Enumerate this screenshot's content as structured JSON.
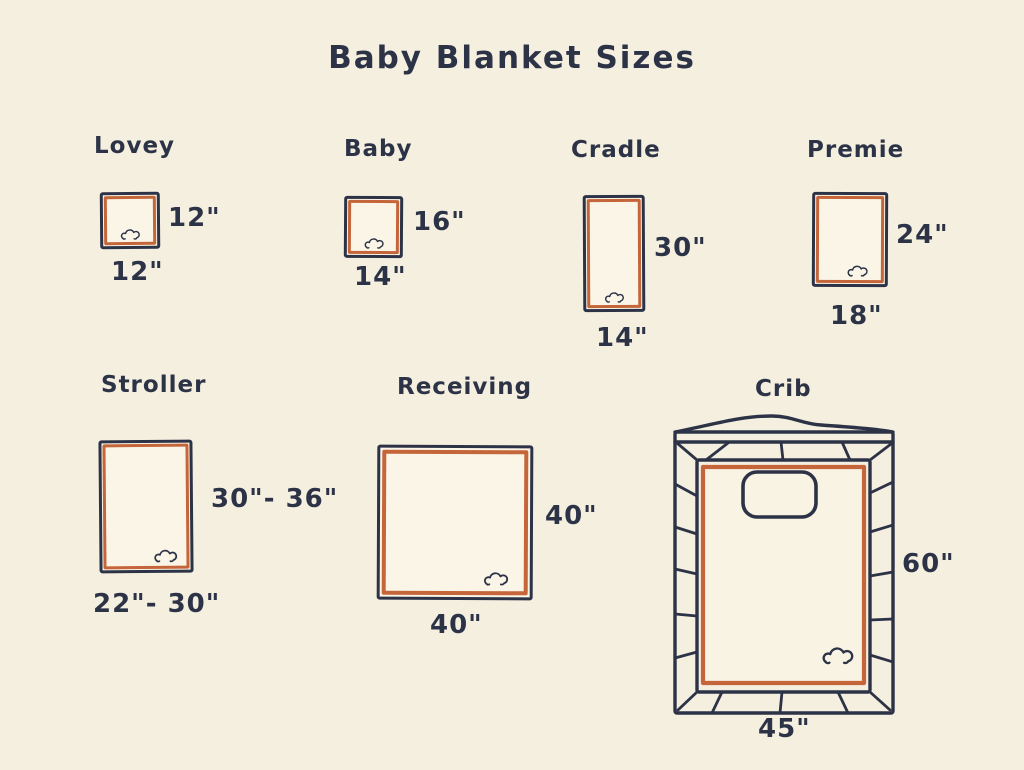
{
  "title": "Baby Blanket Sizes",
  "palette": {
    "background": "#f5efe0",
    "ink": "#2d3347",
    "accent_orange": "#c5653a",
    "blanket_fill": "#faf5e7"
  },
  "icons": {
    "scallop-icon": "small three-arc cloud/scallop trim mark drawn in ink outline"
  },
  "blankets": [
    {
      "label": "Lovey",
      "height": "12\"",
      "width": "12\""
    },
    {
      "label": "Baby",
      "height": "16\"",
      "width": "14\""
    },
    {
      "label": "Cradle",
      "height": "30\"",
      "width": "14\""
    },
    {
      "label": "Premie",
      "height": "24\"",
      "width": "18\""
    },
    {
      "label": "Stroller",
      "height": "30\"- 36\"",
      "width": "22\"- 30\""
    },
    {
      "label": "Receiving",
      "height": "40\"",
      "width": "40\""
    },
    {
      "label": "Crib",
      "height": "60\"",
      "width": "45\""
    }
  ]
}
